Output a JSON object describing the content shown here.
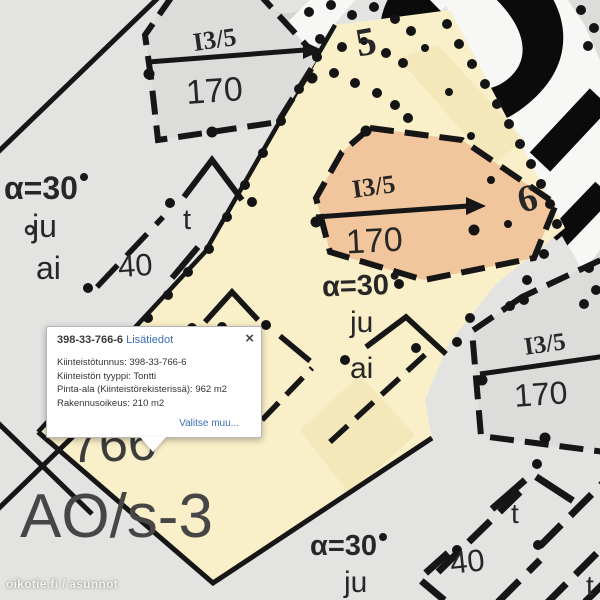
{
  "popup": {
    "title": "398-33-766-6",
    "title_link": "Lisätiedot",
    "close": "×",
    "lines": {
      "l1": "Kiinteistötunnus: 398-33-766-6",
      "l2": "Kiinteistön tyyppi: Tontti",
      "l3": "Pinta-ala (Kiinteistörekisterissä): 962 m2",
      "l4": "Rakennusoikeus: 210 m2"
    },
    "action": "Valitse muu..."
  },
  "watermark": "oikotie.fi / asunnot",
  "background_letters": "OK",
  "colors": {
    "parcel_highlight": "#f9efc8",
    "building_highlight": "#f2c69c",
    "link_blue": "#3b6fb8",
    "marker_green": "#2fae25",
    "line_black": "#161616"
  },
  "labels": {
    "i35_a": "I3/5",
    "n170_a": "170",
    "n5": "5",
    "i35_b": "I3/5",
    "n170_b": "170",
    "alpha_b": "α=30",
    "ju_b": "ju",
    "ai_b": "ai",
    "n6": "6",
    "alpha_l": "α=30",
    "ju_l": "ju",
    "ai_l": "ai",
    "t_l": "t",
    "n40_l": "40",
    "n766": "766",
    "ao": "AO/s-3",
    "i35_c": "I3/5",
    "n170_c": "170",
    "alpha_br": "α=30",
    "ju_br": "ju",
    "t_br1": "t",
    "n40_br": "40",
    "t_br2": "t"
  }
}
